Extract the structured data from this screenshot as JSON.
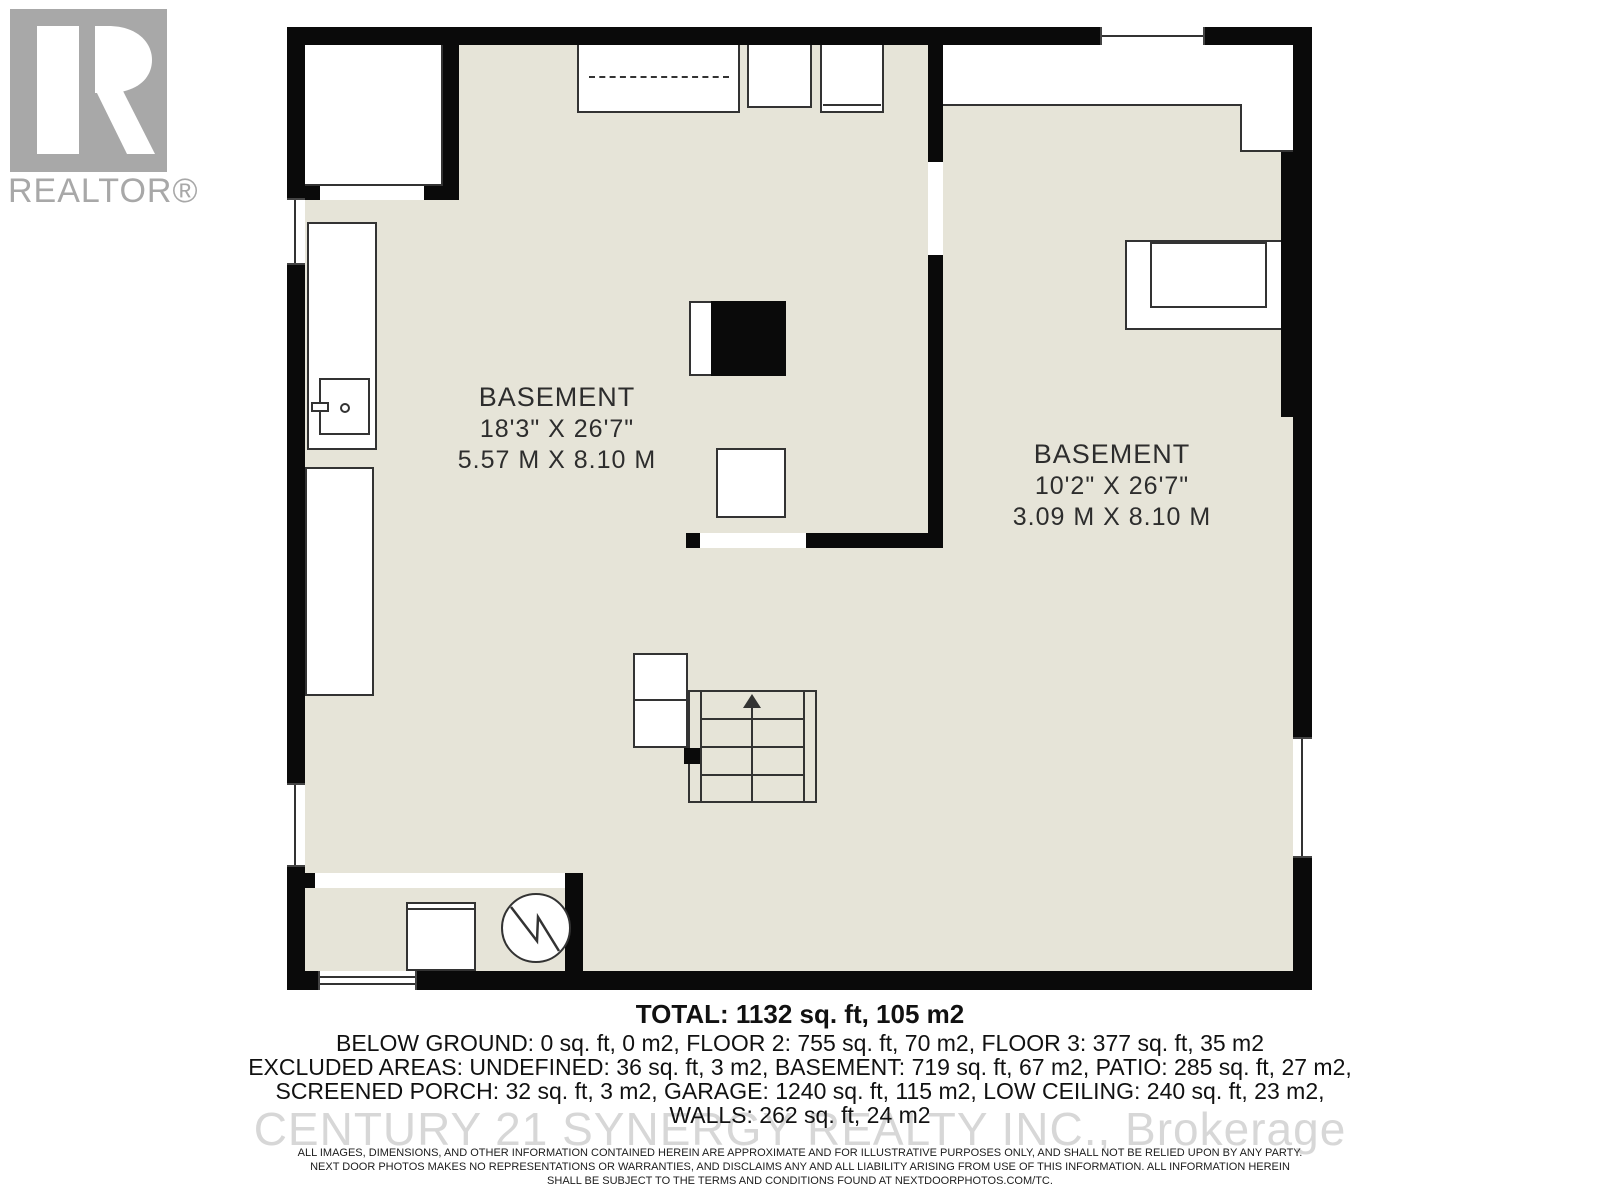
{
  "logo": {
    "label": "REALTOR®"
  },
  "watermark": {
    "text": "CENTURY 21 SYNERGY REALTY INC., Brokerage"
  },
  "rooms": {
    "left": {
      "name": "BASEMENT",
      "imperial": "18'3\" X 26'7\"",
      "metric": "5.57 M X 8.10 M"
    },
    "right": {
      "name": "BASEMENT",
      "imperial": "10'2\" X 26'7\"",
      "metric": "3.09 M X 8.10 M"
    }
  },
  "summary": {
    "total": "TOTAL: 1132 sq. ft, 105 m2",
    "line1": "BELOW GROUND: 0 sq. ft, 0 m2, FLOOR 2: 755 sq. ft, 70 m2, FLOOR 3: 377 sq. ft, 35 m2",
    "line2": "EXCLUDED AREAS: UNDEFINED: 36 sq. ft, 3 m2, BASEMENT: 719 sq. ft, 67 m2, PATIO: 285 sq. ft, 27 m2,",
    "line3": "SCREENED PORCH: 32 sq. ft, 3 m2, GARAGE: 1240 sq. ft, 115 m2, LOW CEILING: 240 sq. ft, 23 m2,",
    "line4": "WALLS: 262 sq. ft, 24 m2"
  },
  "disclaimer": {
    "line1": "ALL IMAGES, DIMENSIONS, AND OTHER INFORMATION CONTAINED HEREIN ARE APPROXIMATE AND FOR ILLUSTRATIVE PURPOSES ONLY, AND SHALL NOT BE RELIED UPON BY ANY PARTY.",
    "line2": "NEXT DOOR PHOTOS MAKES NO REPRESENTATIONS OR WARRANTIES, AND DISCLAIMS ANY AND ALL LIABILITY ARISING FROM USE OF THIS INFORMATION. ALL INFORMATION HEREIN",
    "line3": "SHALL BE SUBJECT TO THE TERMS AND CONDITIONS FOUND AT NEXTDOORPHOTOS.COM/TC."
  },
  "colors": {
    "floor": "#e6e4d8",
    "wall": "#0a0a0a",
    "outline": "#333333",
    "watermark_gray": "#d7d7d7",
    "logo_gray": "#a8a8a8"
  }
}
